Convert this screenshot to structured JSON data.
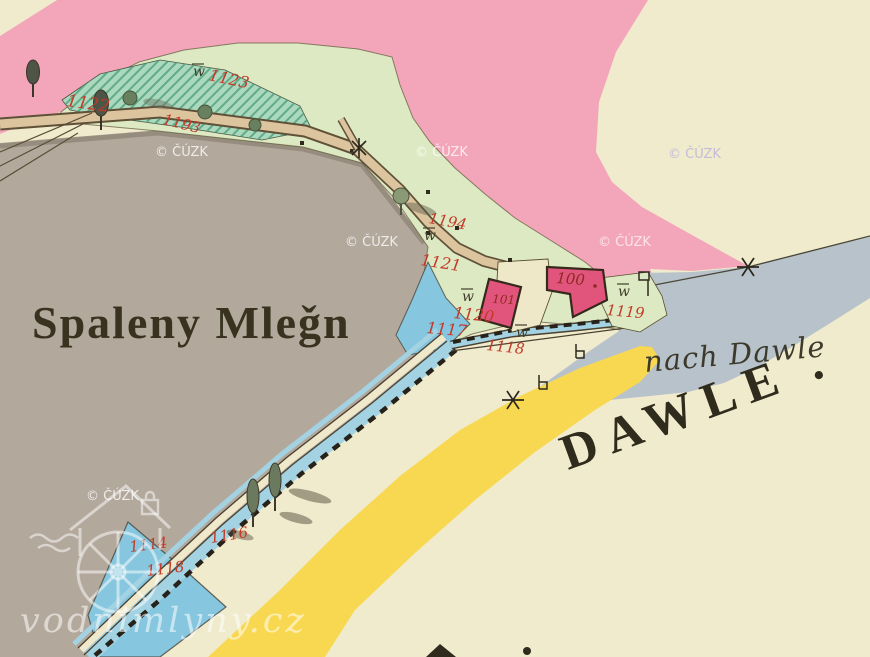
{
  "map": {
    "region_labels": {
      "place": "Spaleny Mleǧn",
      "direction": "nach Dawle",
      "settlement": "DAWLE ."
    },
    "parcels": [
      {
        "text": "1122"
      },
      {
        "text": "1123"
      },
      {
        "text": "1193"
      },
      {
        "text": "1194"
      },
      {
        "text": "1121"
      },
      {
        "text": "1120"
      },
      {
        "text": "1117"
      },
      {
        "text": "1118"
      },
      {
        "text": "1119"
      },
      {
        "text": "100"
      },
      {
        "text": "101."
      },
      {
        "text": "1114"
      },
      {
        "text": "1118"
      },
      {
        "text": "1116"
      }
    ],
    "symbols": {
      "meadow": "w"
    },
    "colors": {
      "background": "#f0ebcd",
      "hillside": "#b3a89c",
      "meadow": "#dde9c3",
      "pasture_hatched": "#abd9bf",
      "boundary_pink": "#f3a6ba",
      "river": "#b8c2ca",
      "pond": "#86c7df",
      "stream": "#a3d2e2",
      "road": "#f8d851",
      "building": "#e1547c",
      "path_tan": "#dcc49e",
      "ink": "#3a3422",
      "parcel_number": "#c23a28",
      "house_number": "#8e2b20"
    }
  },
  "watermarks": {
    "cuzk": "© ČÚZK",
    "site": "vodnimlyny.cz"
  }
}
